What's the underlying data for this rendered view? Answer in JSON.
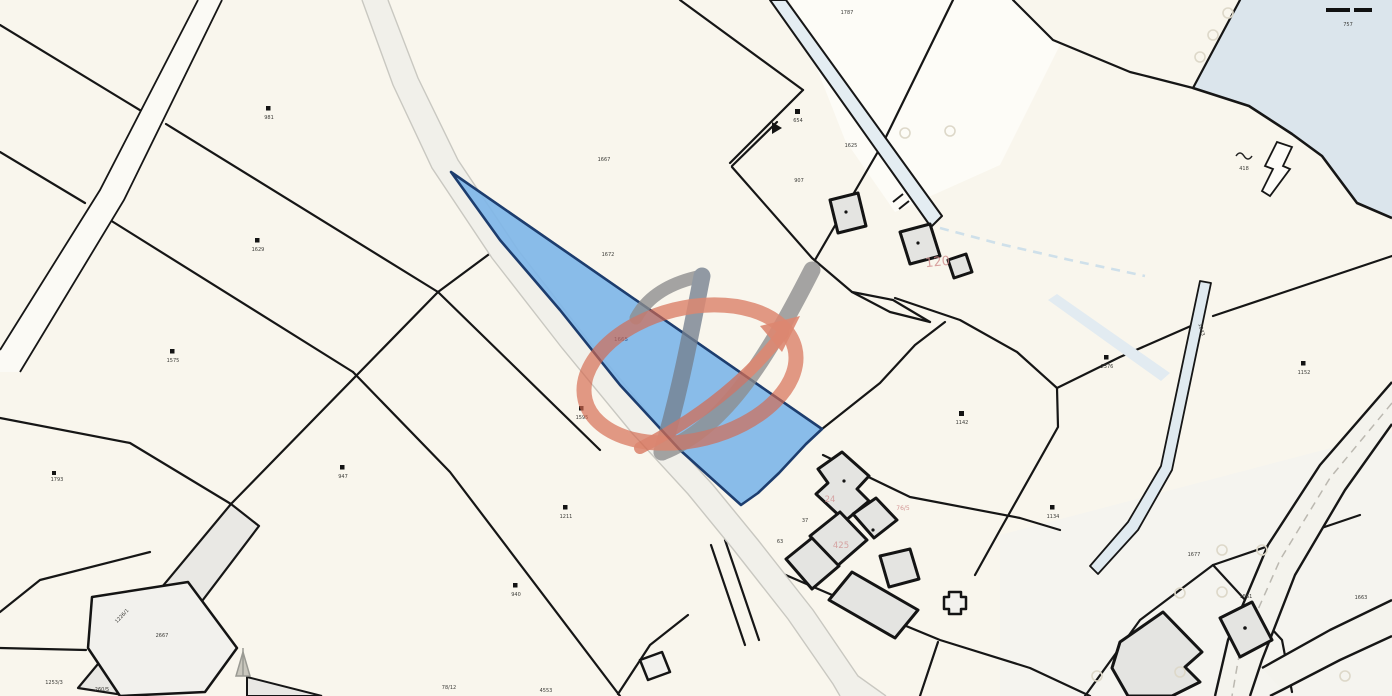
{
  "map": {
    "type": "cadastral-map",
    "colors": {
      "background": "#f9f6ed",
      "boundary_line": "#161616",
      "highlight_fill": "#7fb6e8",
      "highlight_stroke": "#1d3d6e",
      "water": "#dbe5ec",
      "stream": "#e4edf2",
      "building_fill": "#e4e4e1",
      "road_fill": "#f1f0ea",
      "watermark_gray": "#8d8d8d",
      "watermark_slate": "#75808f",
      "watermark_red": "#d5684f"
    },
    "highlight_parcel": {
      "number": "1665"
    },
    "labels": [
      {
        "id": "p0",
        "text": "1667"
      },
      {
        "id": "p1",
        "text": "1672"
      },
      {
        "id": "p2",
        "text": "981"
      },
      {
        "id": "p3",
        "text": "1629"
      },
      {
        "id": "p4",
        "text": "1575"
      },
      {
        "id": "p5",
        "text": "947"
      },
      {
        "id": "p6",
        "text": "1793"
      },
      {
        "id": "p7",
        "text": "1595"
      },
      {
        "id": "p8",
        "text": "1211"
      },
      {
        "id": "p9",
        "text": "940"
      },
      {
        "id": "p10",
        "text": "4553"
      },
      {
        "id": "p11",
        "text": "78/12"
      },
      {
        "id": "p12",
        "text": "1142"
      },
      {
        "id": "p13",
        "text": "2376"
      },
      {
        "id": "p14",
        "text": "1134"
      },
      {
        "id": "p15",
        "text": "1152"
      },
      {
        "id": "p16",
        "text": "654"
      },
      {
        "id": "p17",
        "text": "1625"
      },
      {
        "id": "p18",
        "text": "1787"
      },
      {
        "id": "p19",
        "text": "757"
      },
      {
        "id": "p20",
        "text": "418"
      },
      {
        "id": "p21",
        "text": "907"
      },
      {
        "id": "p22",
        "text": "37"
      },
      {
        "id": "p23",
        "text": "63"
      },
      {
        "id": "p24",
        "text": "1226/1"
      },
      {
        "id": "p25",
        "text": "2667"
      },
      {
        "id": "p26",
        "text": "1253/3"
      },
      {
        "id": "p27",
        "text": "260/5"
      },
      {
        "id": "p28",
        "text": "1043"
      },
      {
        "id": "p29",
        "text": "1677"
      },
      {
        "id": "p30",
        "text": "1561"
      },
      {
        "id": "p31",
        "text": "1663"
      }
    ],
    "red_labels": [
      {
        "id": "r0",
        "text": "120"
      },
      {
        "id": "r1",
        "text": "425"
      },
      {
        "id": "r2",
        "text": "24"
      },
      {
        "id": "r3",
        "text": "76/5"
      }
    ]
  }
}
